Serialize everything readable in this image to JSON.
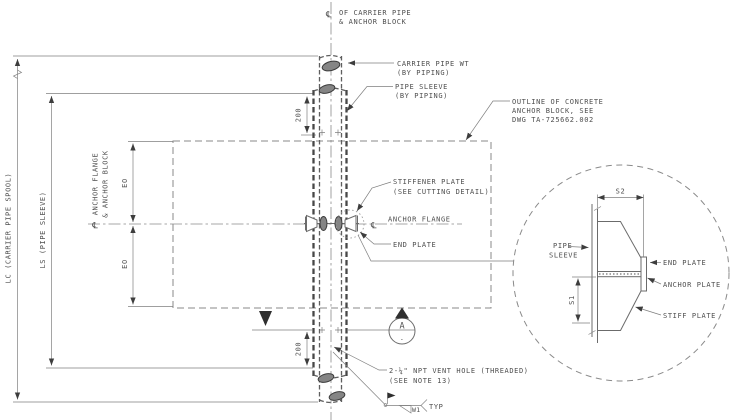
{
  "palette": {
    "background": "#ffffff",
    "line": "#7f7f7f",
    "dark_line": "#474747",
    "text": "#4e4e4e",
    "fill_dark": "#2f2f2f"
  },
  "main_view": {
    "centerline_callout": {
      "symbol": "℄",
      "lines": [
        "OF CARRIER PIPE",
        "& ANCHOR BLOCK"
      ]
    },
    "callouts": {
      "carrier_pipe_wt": {
        "lines": [
          "CARRIER PIPE WT",
          "(BY PIPING)"
        ]
      },
      "pipe_sleeve": {
        "lines": [
          "PIPE SLEEVE",
          "(BY PIPING)"
        ]
      },
      "concrete_outline": {
        "lines": [
          "OUTLINE OF CONCRETE",
          "ANCHOR BLOCK, SEE",
          "DWG TA-725662.002"
        ]
      },
      "stiffener_plate": {
        "lines": [
          "STIFFENER PLATE",
          "(SEE CUTTING DETAIL)"
        ]
      },
      "anchor_flange": {
        "symbol": "℄",
        "text": "ANCHOR FLANGE"
      },
      "end_plate": {
        "text": "END PLATE"
      },
      "vent_hole": {
        "lines": [
          "2-¼\" NPT VENT HOLE (THREADED)",
          "(SEE NOTE 13)"
        ]
      }
    },
    "dimensions": {
      "lc_label": "LC (CARRIER PIPE SPOOL)",
      "ls_label": "LS (PIPE SLEEVE)",
      "anchor_axis": {
        "symbol": "℄",
        "lines": [
          "ANCHOR FLANGE",
          "& ANCHOR BLOCK"
        ]
      },
      "top_offset": "200",
      "bottom_offset": "200",
      "eo_upper": "EO",
      "eo_lower": "EO"
    },
    "section_marker": {
      "letter": "A",
      "dash": "-"
    },
    "weld_callout": {
      "size": "W1",
      "note": "TYP"
    }
  },
  "detail_view": {
    "callouts": {
      "pipe_sleeve": {
        "lines": [
          "PIPE",
          "SLEEVE"
        ]
      },
      "end_plate": "END PLATE",
      "anchor_plate": "ANCHOR PLATE",
      "stiff_plate": "STIFF PLATE"
    },
    "dimensions": {
      "s2": "S2",
      "s1": "S1"
    }
  }
}
